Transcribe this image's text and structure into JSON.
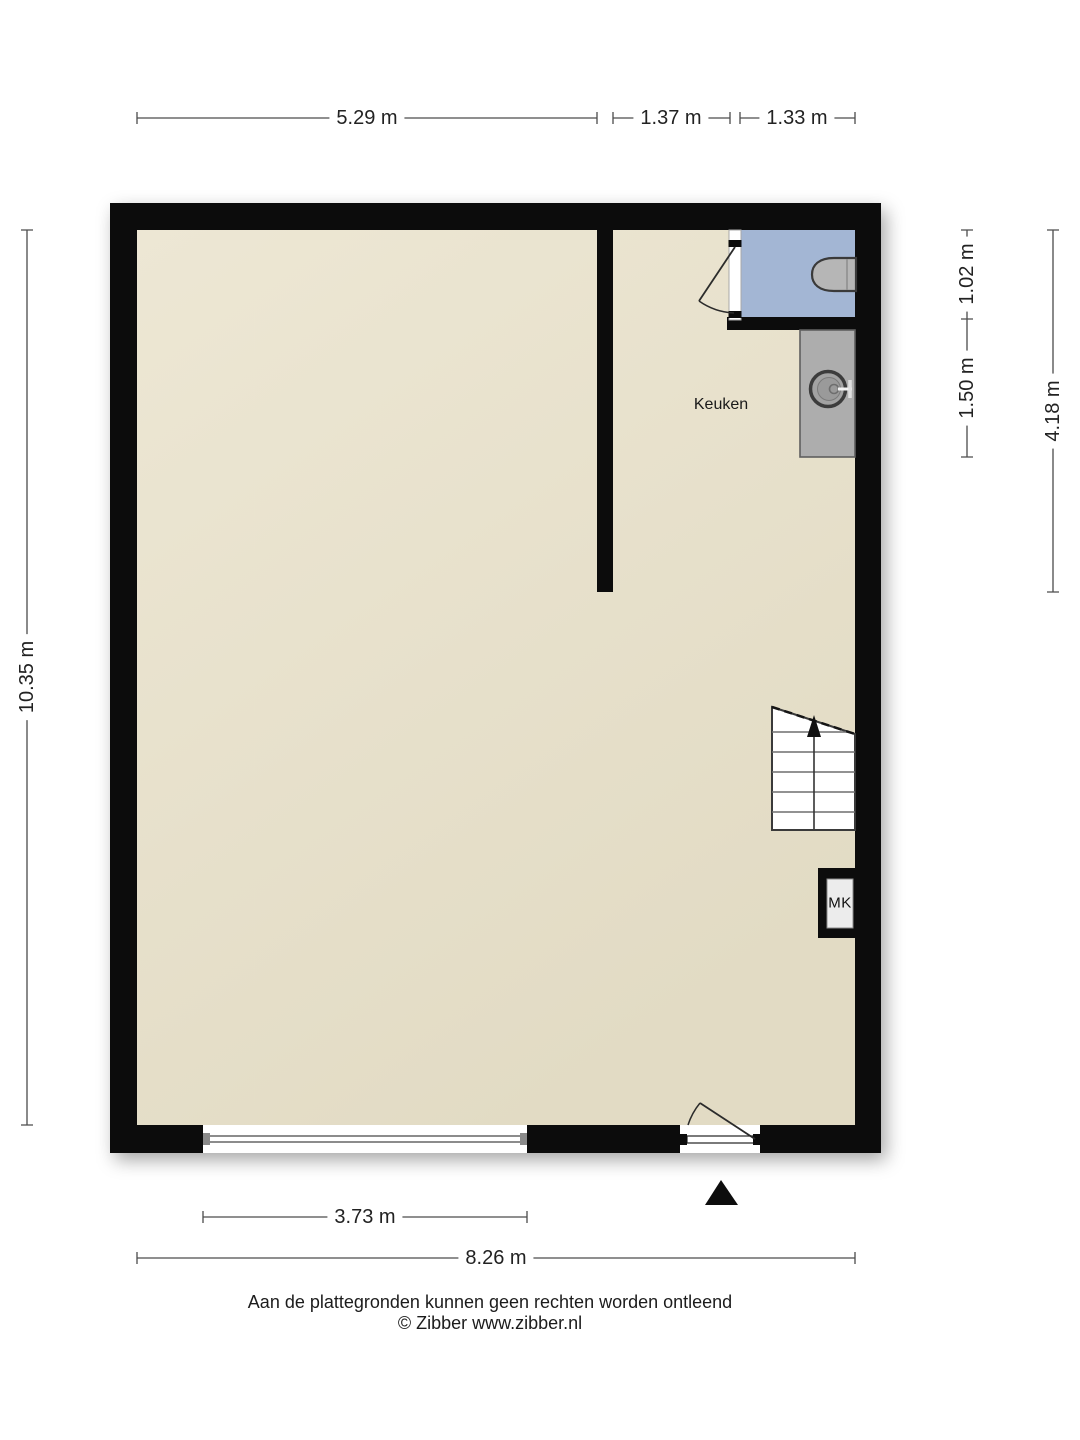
{
  "plan": {
    "room_label": "Keuken",
    "meter_closet_label": "MK",
    "dimensions": {
      "top": [
        "5.29 m",
        "1.37 m",
        "1.33 m"
      ],
      "left": "10.35 m",
      "right_inner_top": "1.02 m",
      "right_inner_bottom": "1.50 m",
      "right_outer": "4.18 m",
      "window_width": "3.73 m",
      "total_width": "8.26 m"
    },
    "colors": {
      "wall": "#0c0c0c",
      "floor": "#e6dfc9",
      "wet_room_floor": "#a3b6d4",
      "counter": "#adadad"
    }
  },
  "footer": {
    "disclaimer": "Aan de plattegronden kunnen geen rechten worden ontleend",
    "copyright": "© Zibber www.zibber.nl"
  }
}
